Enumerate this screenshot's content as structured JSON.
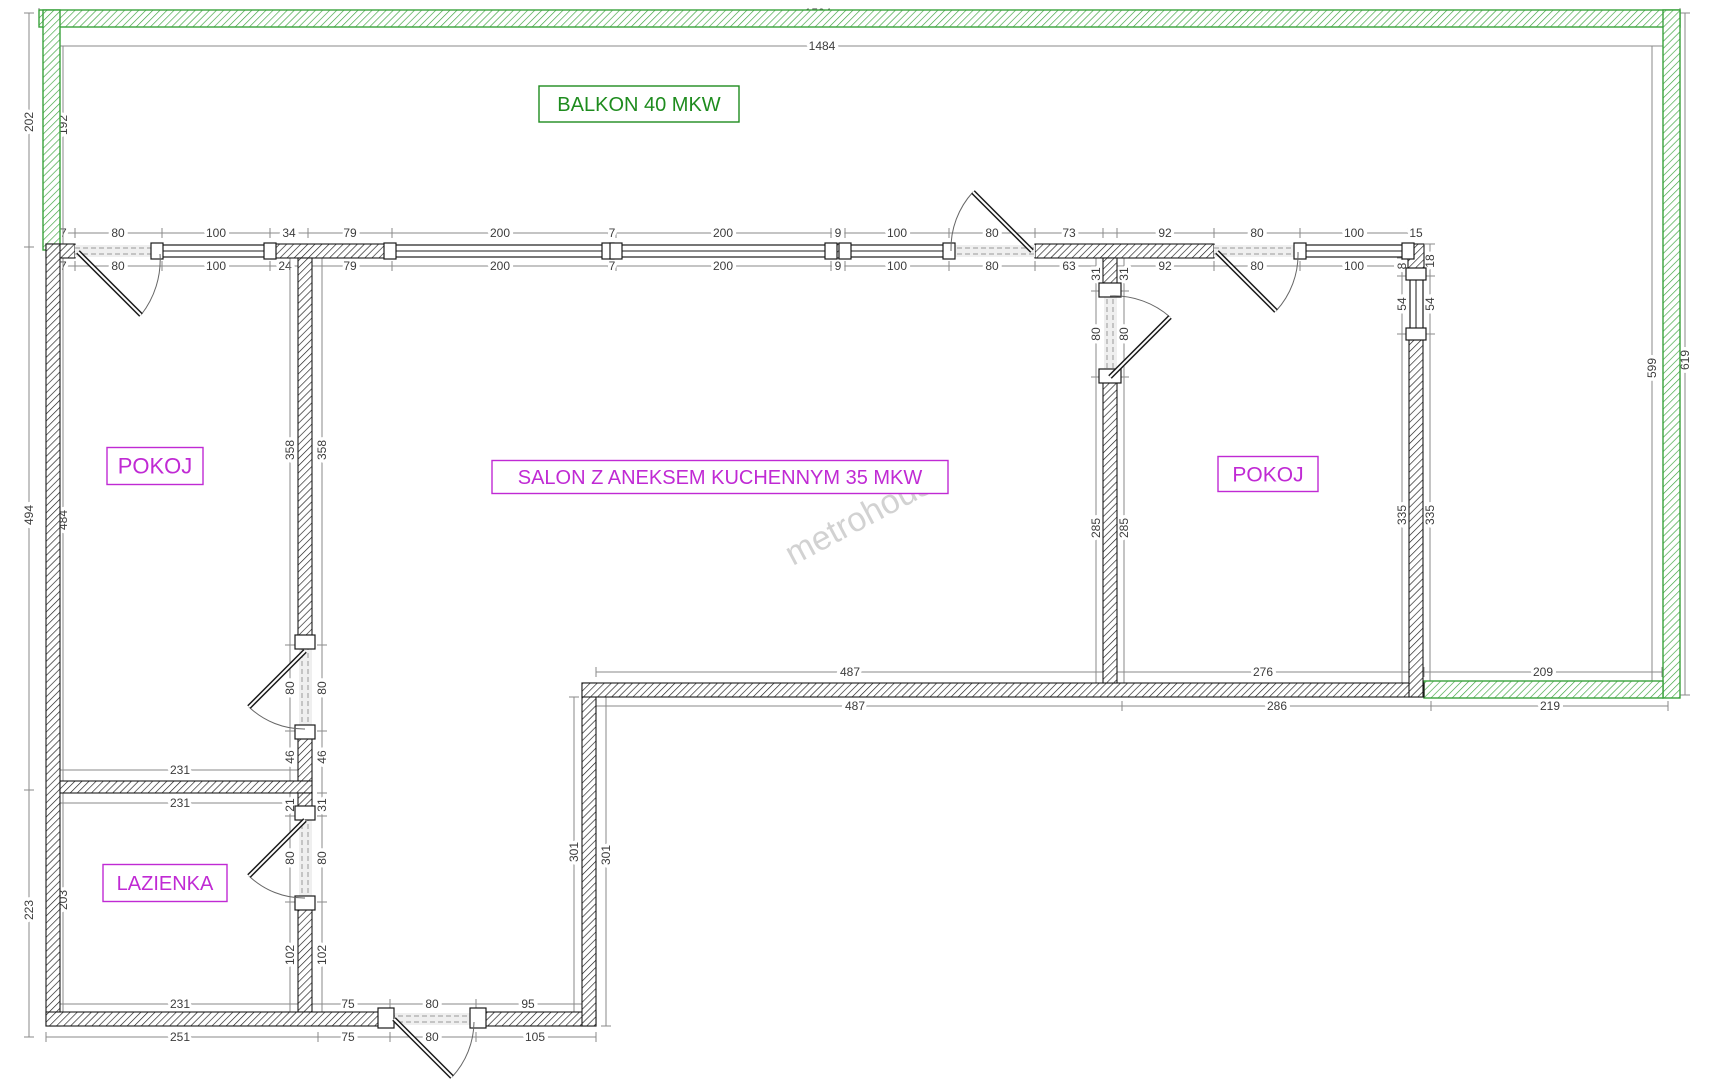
{
  "meta": {
    "type": "apartment-floor-plan",
    "watermark_text": "metrohouse"
  },
  "colors": {
    "wall": "#1b1b1b",
    "balcony": "#3aa23c",
    "balcony_text": "#1e8c1e",
    "room_text": "#c02ad4",
    "dim_text": "#3c3c3c",
    "dim_line": "#8a8a8a",
    "watermark": "#c8c8c8",
    "opening_fill": "#efefef"
  },
  "rooms": [
    {
      "key": "balkon",
      "label": "BALKON 40 MKW",
      "cx": 639,
      "cy": 104,
      "w": 200,
      "h": 36,
      "color": "balcony_text",
      "fs": 20
    },
    {
      "key": "pokoj_left",
      "label": "POKOJ",
      "cx": 155,
      "cy": 466,
      "w": 96,
      "h": 37,
      "color": "room_text",
      "fs": 22
    },
    {
      "key": "salon",
      "label": "SALON Z ANEKSEM KUCHENNYM 35 MKW",
      "cx": 720,
      "cy": 477,
      "w": 456,
      "h": 33,
      "color": "room_text",
      "fs": 20
    },
    {
      "key": "pokoj_right",
      "label": "POKOJ",
      "cx": 1268,
      "cy": 474,
      "w": 100,
      "h": 35,
      "color": "room_text",
      "fs": 21
    },
    {
      "key": "lazienka",
      "label": "LAZIENKA",
      "cx": 165,
      "cy": 883,
      "w": 124,
      "h": 37,
      "color": "room_text",
      "fs": 20
    }
  ],
  "watermark": {
    "text": "metrohouse",
    "cx": 872,
    "cy": 524,
    "rot": -28,
    "fs": 34
  },
  "balcony_walls": [
    [
      39,
      10,
      1641,
      17
    ],
    [
      43,
      10,
      17,
      240
    ],
    [
      1663,
      10,
      17,
      688
    ],
    [
      1424,
      681,
      239,
      17
    ]
  ],
  "interior_walls": [
    [
      46,
      244,
      29,
      14
    ],
    [
      270,
      244,
      122,
      14
    ],
    [
      608,
      244,
      8,
      14
    ],
    [
      836,
      244,
      9,
      14
    ],
    [
      1035,
      244,
      179,
      14
    ],
    [
      1408,
      244,
      16,
      32
    ],
    [
      46,
      244,
      14,
      782
    ],
    [
      298,
      258,
      14,
      387
    ],
    [
      298,
      738,
      14,
      43
    ],
    [
      60,
      781,
      252,
      12
    ],
    [
      298,
      793,
      14,
      23
    ],
    [
      298,
      902,
      14,
      110
    ],
    [
      46,
      1012,
      344,
      14
    ],
    [
      476,
      1012,
      120,
      14
    ],
    [
      582,
      683,
      14,
      343
    ],
    [
      582,
      683,
      842,
      14
    ],
    [
      1103,
      258,
      14,
      33
    ],
    [
      1103,
      377,
      14,
      306
    ],
    [
      1409,
      334,
      14,
      363
    ]
  ],
  "windows": {
    "horizontal": [
      [
        162,
        245,
        108
      ],
      [
        392,
        245,
        216
      ],
      [
        616,
        245,
        215
      ],
      [
        845,
        245,
        104
      ],
      [
        1300,
        245,
        108
      ]
    ],
    "vertical": [
      [
        1410,
        276,
        58
      ]
    ]
  },
  "door_openings": {
    "horizontal": [
      [
        75,
        245,
        87
      ],
      [
        949,
        245,
        86
      ],
      [
        1214,
        245,
        86
      ],
      [
        390,
        1013,
        86
      ]
    ],
    "vertical": [
      [
        1104,
        291,
        86
      ],
      [
        299,
        645,
        86
      ],
      [
        299,
        816,
        86
      ]
    ]
  },
  "jambs": [
    [
      151,
      243,
      12,
      16
    ],
    [
      264,
      243,
      12,
      16
    ],
    [
      384,
      243,
      12,
      16
    ],
    [
      602,
      243,
      12,
      16
    ],
    [
      610,
      243,
      12,
      16
    ],
    [
      825,
      243,
      12,
      16
    ],
    [
      839,
      243,
      12,
      16
    ],
    [
      943,
      243,
      12,
      16
    ],
    [
      1294,
      243,
      12,
      16
    ],
    [
      1402,
      243,
      12,
      16
    ],
    [
      1406,
      268,
      20,
      12
    ],
    [
      1406,
      328,
      20,
      12
    ],
    [
      295,
      635,
      20,
      14
    ],
    [
      295,
      725,
      20,
      14
    ],
    [
      295,
      806,
      20,
      14
    ],
    [
      295,
      896,
      20,
      14
    ],
    [
      1099,
      283,
      22,
      14
    ],
    [
      1099,
      369,
      22,
      14
    ],
    [
      378,
      1008,
      16,
      20
    ],
    [
      470,
      1008,
      16,
      20
    ]
  ],
  "doors": [
    {
      "name": "balcony-door-left",
      "h": [
        78,
        252
      ],
      "t": [
        141,
        315
      ],
      "a": [
        160,
        254
      ]
    },
    {
      "name": "balcony-door-salon",
      "h": [
        1032,
        251
      ],
      "t": [
        973,
        192
      ],
      "a": [
        951,
        251
      ]
    },
    {
      "name": "balcony-door-right",
      "h": [
        1217,
        252
      ],
      "t": [
        1276,
        311
      ],
      "a": [
        1298,
        252
      ]
    },
    {
      "name": "salon-pokoj-door",
      "h": [
        1110,
        377
      ],
      "t": [
        1170,
        317
      ],
      "a": [
        1110,
        296
      ]
    },
    {
      "name": "pokoj-left-door",
      "h": [
        305,
        651
      ],
      "t": [
        249,
        707
      ],
      "a": [
        305,
        729
      ]
    },
    {
      "name": "lazienka-door",
      "h": [
        305,
        820
      ],
      "t": [
        249,
        876
      ],
      "a": [
        305,
        898
      ]
    },
    {
      "name": "entrance-door",
      "h": [
        394,
        1019
      ],
      "t": [
        452,
        1077
      ],
      "a": [
        474,
        1022
      ]
    }
  ],
  "dims": {
    "chains": [
      {
        "o": "h",
        "p": 13,
        "f": 39,
        "e": 1680,
        "ticks": [
          39,
          1680
        ],
        "labels": [
          {
            "t": "1504",
            "at": 818
          }
        ]
      },
      {
        "o": "h",
        "p": 46,
        "f": 56,
        "e": 1663,
        "ticks": [
          56,
          1663
        ],
        "labels": [
          {
            "t": "1484",
            "at": 822
          }
        ]
      },
      {
        "o": "h",
        "p": 233,
        "f": 46,
        "e": 1424,
        "ticks": [
          46,
          75,
          162,
          270,
          308,
          392,
          608,
          616,
          831,
          845,
          949,
          1035,
          1103,
          1117,
          1214,
          1300,
          1408,
          1424
        ],
        "labels": [
          {
            "t": "27",
            "at": 60
          },
          {
            "t": "80",
            "at": 118
          },
          {
            "t": "100",
            "at": 216
          },
          {
            "t": "34",
            "at": 289
          },
          {
            "t": "79",
            "at": 350
          },
          {
            "t": "200",
            "at": 500
          },
          {
            "t": "7",
            "at": 612
          },
          {
            "t": "200",
            "at": 723
          },
          {
            "t": "9",
            "at": 838
          },
          {
            "t": "100",
            "at": 897
          },
          {
            "t": "80",
            "at": 992
          },
          {
            "t": "73",
            "at": 1069
          },
          {
            "t": "92",
            "at": 1165
          },
          {
            "t": "80",
            "at": 1257
          },
          {
            "t": "100",
            "at": 1354
          },
          {
            "t": "15",
            "at": 1416
          }
        ]
      },
      {
        "o": "h",
        "p": 266,
        "f": 46,
        "e": 1408,
        "ticks": [
          46,
          75,
          162,
          270,
          300,
          392,
          608,
          616,
          831,
          845,
          949,
          1035,
          1103,
          1117,
          1214,
          1300,
          1408
        ],
        "labels": [
          {
            "t": "27",
            "at": 60
          },
          {
            "t": "80",
            "at": 118
          },
          {
            "t": "100",
            "at": 216
          },
          {
            "t": "24",
            "at": 285
          },
          {
            "t": "79",
            "at": 350
          },
          {
            "t": "200",
            "at": 500
          },
          {
            "t": "7",
            "at": 612
          },
          {
            "t": "200",
            "at": 723
          },
          {
            "t": "9",
            "at": 838
          },
          {
            "t": "100",
            "at": 897
          },
          {
            "t": "80",
            "at": 992
          },
          {
            "t": "63",
            "at": 1069
          },
          {
            "t": "92",
            "at": 1165
          },
          {
            "t": "80",
            "at": 1257
          },
          {
            "t": "100",
            "at": 1354
          }
        ]
      },
      {
        "o": "h",
        "p": 672,
        "f": 596,
        "e": 1662,
        "ticks": [
          596,
          1103,
          1117,
          1409,
          1424,
          1662
        ],
        "labels": [
          {
            "t": "487",
            "at": 850
          },
          {
            "t": "276",
            "at": 1263
          },
          {
            "t": "209",
            "at": 1543
          }
        ]
      },
      {
        "o": "h",
        "p": 706,
        "f": 596,
        "e": 1668,
        "ticks": [
          596,
          1122,
          1431,
          1668
        ],
        "labels": [
          {
            "t": "487",
            "at": 855
          },
          {
            "t": "286",
            "at": 1277
          },
          {
            "t": "219",
            "at": 1550
          }
        ]
      },
      {
        "o": "h",
        "p": 770,
        "f": 60,
        "e": 302,
        "ticks": [
          60,
          302
        ],
        "labels": [
          {
            "t": "231",
            "at": 180
          }
        ]
      },
      {
        "o": "h",
        "p": 803,
        "f": 60,
        "e": 302,
        "ticks": [
          60,
          302
        ],
        "labels": [
          {
            "t": "231",
            "at": 180
          }
        ]
      },
      {
        "o": "h",
        "p": 1004,
        "f": 60,
        "e": 582,
        "ticks": [
          60,
          307,
          390,
          476,
          582
        ],
        "labels": [
          {
            "t": "231",
            "at": 180
          },
          {
            "t": "75",
            "at": 348
          },
          {
            "t": "80",
            "at": 432
          },
          {
            "t": "95",
            "at": 528
          }
        ]
      },
      {
        "o": "h",
        "p": 1037,
        "f": 46,
        "e": 596,
        "ticks": [
          46,
          318,
          390,
          476,
          596
        ],
        "labels": [
          {
            "t": "251",
            "at": 180
          },
          {
            "t": "75",
            "at": 348
          },
          {
            "t": "80",
            "at": 432
          },
          {
            "t": "105",
            "at": 535
          }
        ]
      },
      {
        "o": "v",
        "p": 29,
        "f": 13,
        "e": 1037,
        "ticks": [
          13,
          247,
          790,
          1037
        ],
        "labels": [
          {
            "t": "202",
            "at": 122
          },
          {
            "t": "494",
            "at": 515
          },
          {
            "t": "223",
            "at": 910
          }
        ]
      },
      {
        "o": "v",
        "p": 63,
        "f": 46,
        "e": 1012,
        "ticks": [
          46,
          258,
          781,
          1012
        ],
        "labels": [
          {
            "t": "192",
            "at": 125
          },
          {
            "t": "484",
            "at": 520
          },
          {
            "t": "203",
            "at": 900
          }
        ]
      },
      {
        "o": "v",
        "p": 1652,
        "f": 46,
        "e": 695,
        "ticks": [
          46,
          695
        ],
        "labels": [
          {
            "t": "599",
            "at": 368
          }
        ]
      },
      {
        "o": "v",
        "p": 1685,
        "f": 13,
        "e": 695,
        "ticks": [
          13,
          695
        ],
        "labels": [
          {
            "t": "619",
            "at": 360
          }
        ]
      },
      {
        "o": "v",
        "p": 290,
        "f": 258,
        "e": 1012,
        "ticks": [
          258,
          645,
          731,
          781,
          793,
          816,
          902,
          1012
        ],
        "labels": [
          {
            "t": "358",
            "at": 450
          },
          {
            "t": "80",
            "at": 688
          },
          {
            "t": "46",
            "at": 757
          },
          {
            "t": "21",
            "at": 805
          },
          {
            "t": "80",
            "at": 858
          },
          {
            "t": "102",
            "at": 955
          }
        ]
      },
      {
        "o": "v",
        "p": 322,
        "f": 258,
        "e": 1012,
        "ticks": [
          258,
          645,
          731,
          793,
          816,
          902,
          1012
        ],
        "labels": [
          {
            "t": "358",
            "at": 450
          },
          {
            "t": "80",
            "at": 688
          },
          {
            "t": "46",
            "at": 757
          },
          {
            "t": "31",
            "at": 805
          },
          {
            "t": "80",
            "at": 858
          },
          {
            "t": "102",
            "at": 955
          }
        ]
      },
      {
        "o": "v",
        "p": 1096,
        "f": 258,
        "e": 683,
        "ticks": [
          258,
          291,
          377,
          683
        ],
        "labels": [
          {
            "t": "31",
            "at": 274
          },
          {
            "t": "80",
            "at": 334
          },
          {
            "t": "285",
            "at": 528
          }
        ]
      },
      {
        "o": "v",
        "p": 1124,
        "f": 258,
        "e": 683,
        "ticks": [
          258,
          291,
          377,
          683
        ],
        "labels": [
          {
            "t": "31",
            "at": 274
          },
          {
            "t": "80",
            "at": 334
          },
          {
            "t": "285",
            "at": 528
          }
        ]
      },
      {
        "o": "v",
        "p": 1402,
        "f": 258,
        "e": 697,
        "ticks": [
          258,
          276,
          334,
          697
        ],
        "labels": [
          {
            "t": "8",
            "at": 266
          },
          {
            "t": "54",
            "at": 304
          },
          {
            "t": "335",
            "at": 515
          }
        ]
      },
      {
        "o": "v",
        "p": 1430,
        "f": 244,
        "e": 697,
        "ticks": [
          244,
          276,
          334,
          697
        ],
        "labels": [
          {
            "t": "18",
            "at": 261
          },
          {
            "t": "54",
            "at": 304
          },
          {
            "t": "335",
            "at": 515
          }
        ]
      },
      {
        "o": "v",
        "p": 574,
        "f": 697,
        "e": 1012,
        "ticks": [
          697,
          1012
        ],
        "labels": [
          {
            "t": "301",
            "at": 852
          }
        ]
      },
      {
        "o": "v",
        "p": 606,
        "f": 683,
        "e": 1026,
        "ticks": [
          683,
          1026
        ],
        "labels": [
          {
            "t": "301",
            "at": 855
          }
        ]
      }
    ],
    "extra_labels": [
      {
        "t": "5",
        "x": 1414,
        "y": 269
      }
    ]
  }
}
